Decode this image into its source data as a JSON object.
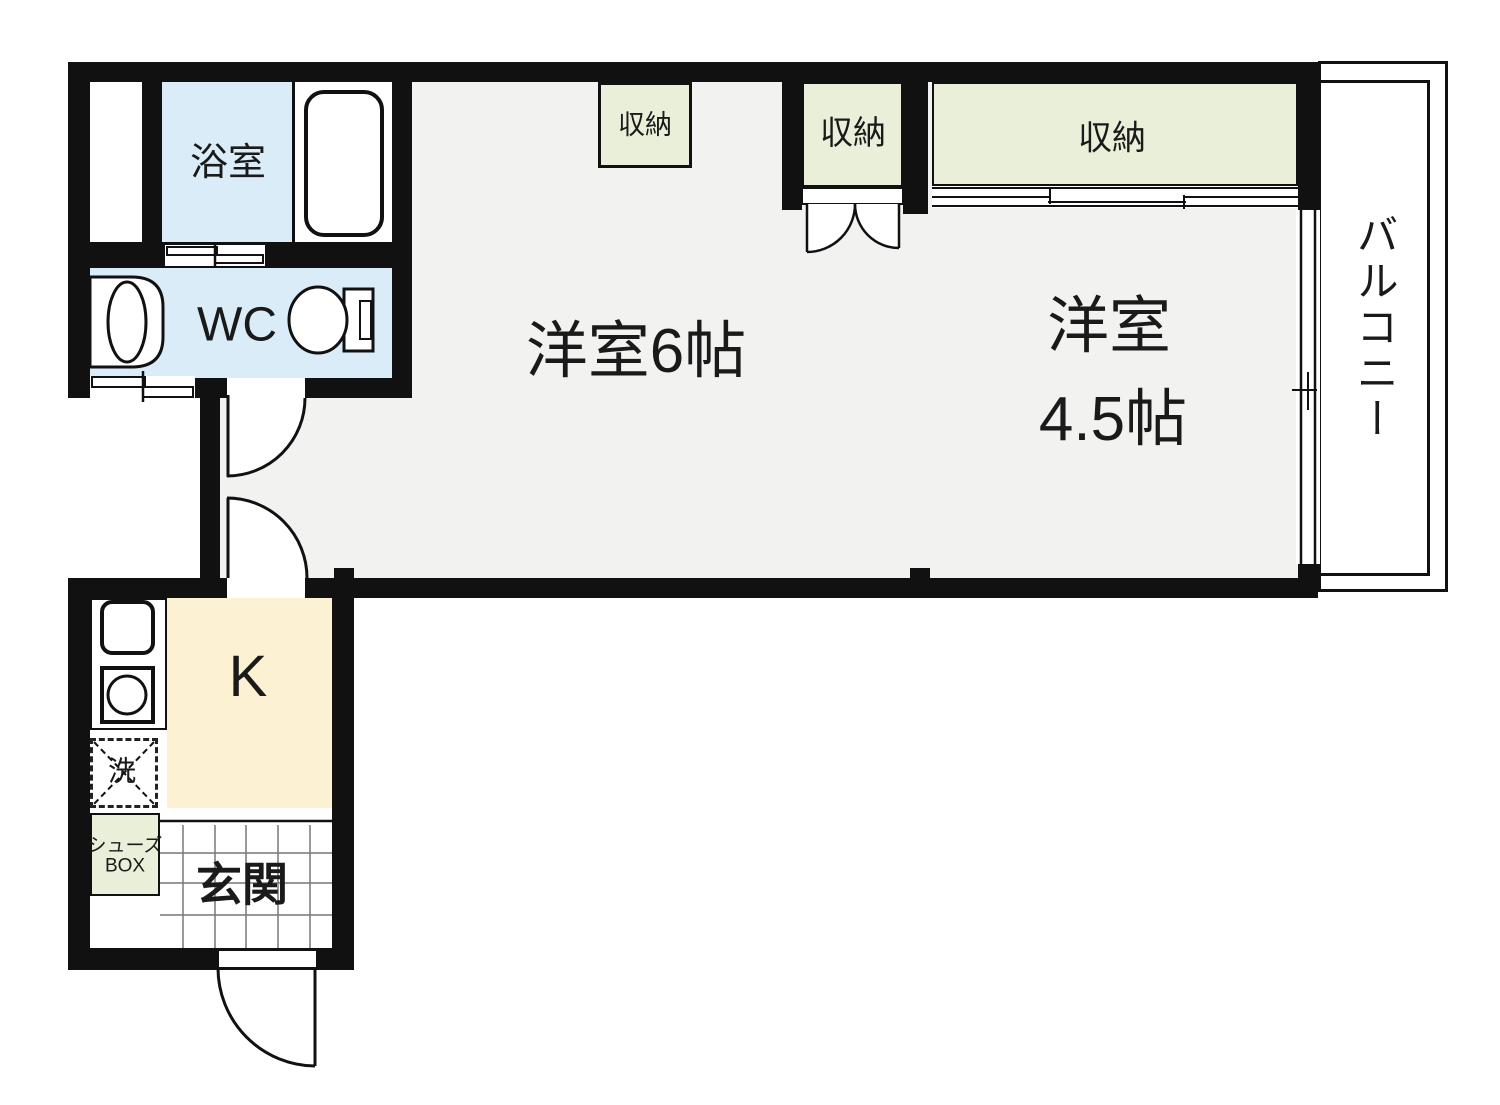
{
  "labels": {
    "bath": "浴室",
    "wc": "WC",
    "closet_small": "収納",
    "closet_middle": "収納",
    "closet_right": "収納",
    "room6": "洋室6帖",
    "room45_name": "洋室",
    "room45_size": "4.5帖",
    "balcony": "バルコニー",
    "kitchen": "K",
    "laundry": "洗",
    "shoebox_line1": "シューズ",
    "shoebox_line2": "BOX",
    "entrance": "玄関"
  },
  "colors": {
    "wall": "#111111",
    "floor": "#f2f2f1",
    "wet_blue": "#d9ecf8",
    "closet_green": "#e9efd8",
    "kitchen_cream": "#fcf1d3",
    "tile_line": "#777777"
  }
}
